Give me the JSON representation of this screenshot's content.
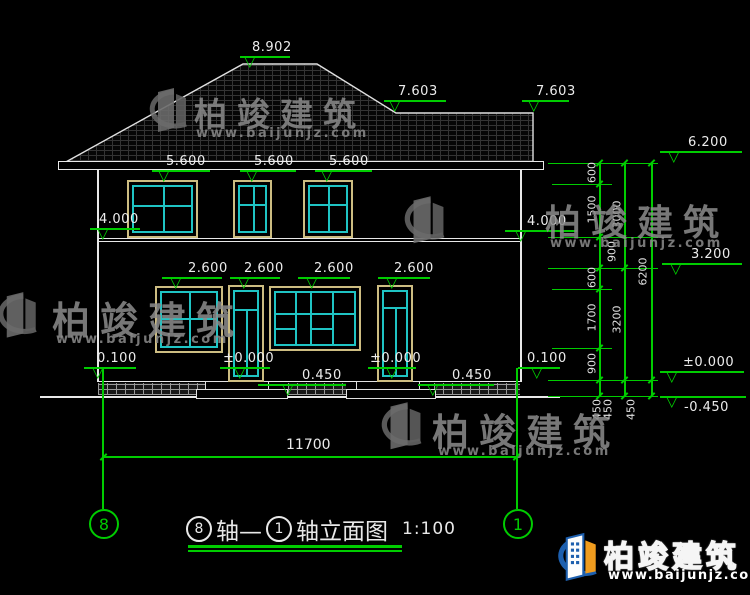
{
  "watermark": {
    "brand": "柏竣建筑",
    "url": "www.baijunjz.com"
  },
  "title": {
    "axis_left": "8",
    "axis_sep": "轴—",
    "axis_right": "1",
    "text": "轴立面图",
    "scale": "1:100"
  },
  "axes": {
    "left": "8",
    "right": "1"
  },
  "levels": {
    "peak": "8.902",
    "ridge_l": "7.603",
    "ridge_r": "7.603",
    "eave": "6.200",
    "w2a": "5.600",
    "w2b": "5.600",
    "w2c": "5.600",
    "f2l": "4.000",
    "f2r": "4.000",
    "mid": "3.200",
    "w1a": "2.600",
    "w1b": "2.600",
    "w1c": "2.600",
    "w1d": "2.600",
    "pll": "0.100",
    "plr": "0.100",
    "d1": "±0.000",
    "d2": "±0.000",
    "zr": "±0.000",
    "s1": "0.450",
    "s2": "0.450",
    "gnd": "-0.450"
  },
  "dims": {
    "total": "11700",
    "a1": "600",
    "a2": "1500",
    "a3": "900",
    "a4": "600",
    "a5": "1700",
    "a6": "900",
    "b1": "3000",
    "b2": "3200",
    "c1": "6200",
    "f1": "450",
    "f2": "450",
    "f3": "450"
  },
  "colors": {
    "green": "#00cc00",
    "line": "#e8e8e8",
    "glass": "#1fc4c4",
    "frame": "#cdbd82",
    "logo_blue": "#1d5fae",
    "logo_orange": "#f09c1e"
  }
}
